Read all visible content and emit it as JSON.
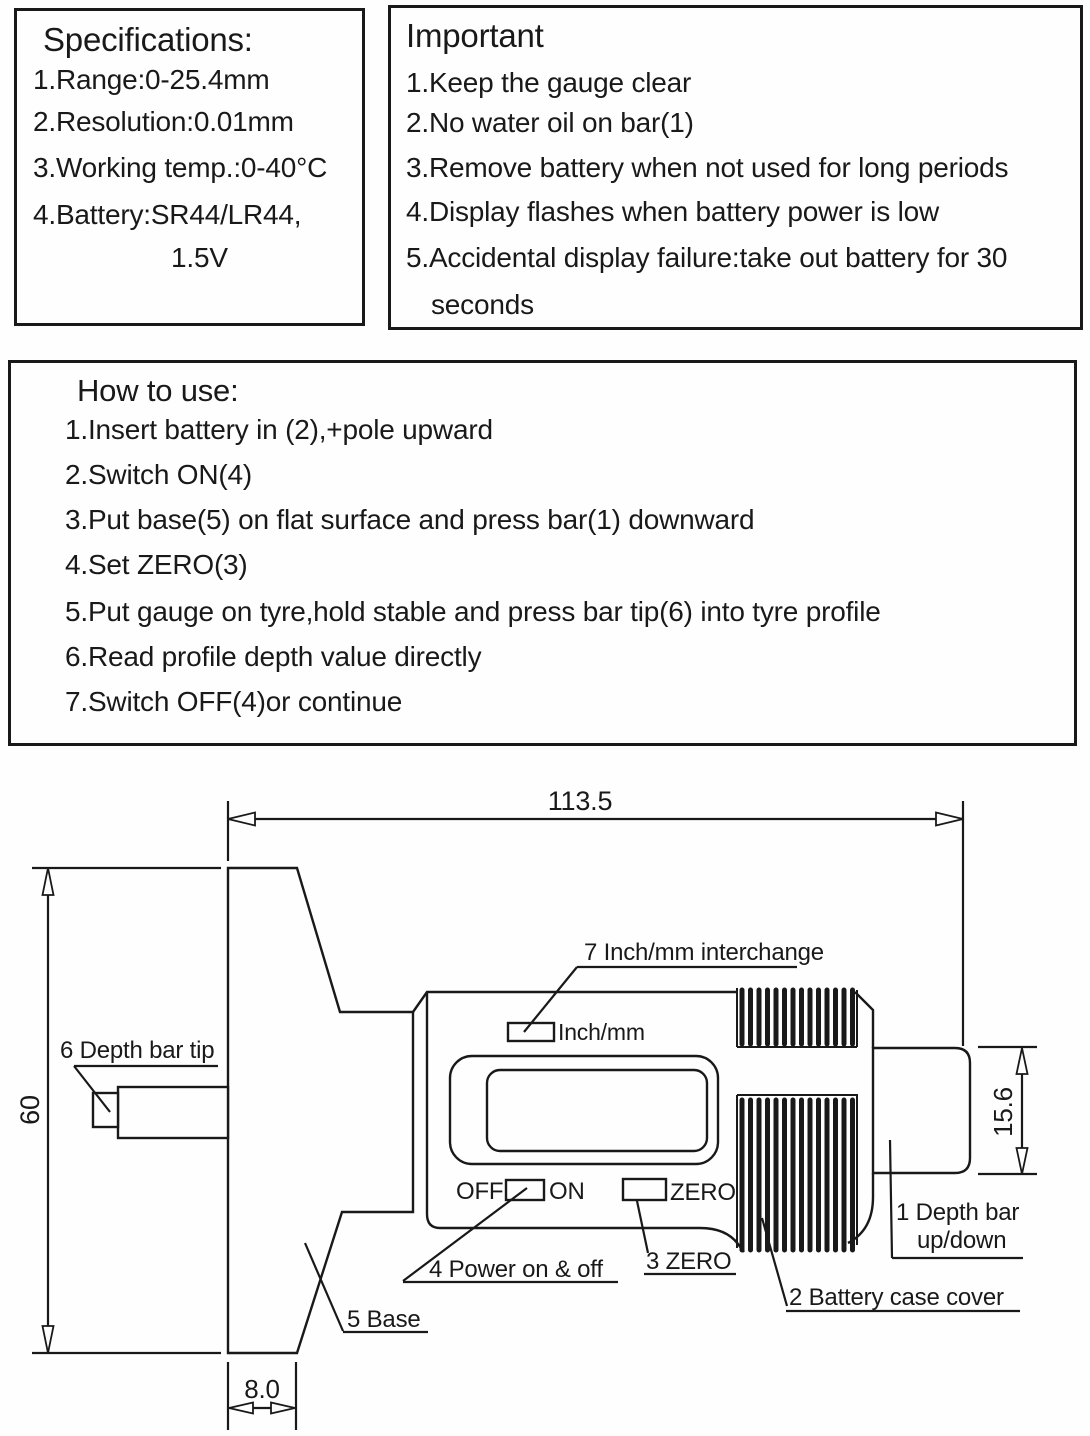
{
  "specifications": {
    "title": "Specifications:",
    "items": [
      "1.Range:0-25.4mm",
      "2.Resolution:0.01mm",
      "3.Working temp.:0-40°C",
      "4.Battery:SR44/LR44,",
      "1.5V"
    ]
  },
  "important": {
    "title": "Important",
    "items": [
      "1.Keep the gauge clear",
      "2.No water oil on bar(1)",
      "3.Remove battery when not used for long periods",
      "4.Display flashes when battery power is low",
      "5.Accidental display failure:take out battery for 30",
      "seconds"
    ]
  },
  "how_to_use": {
    "title": "How to use:",
    "items": [
      "1.Insert battery in (2),+pole upward",
      "2.Switch ON(4)",
      "3.Put base(5) on flat surface and press bar(1) downward",
      "4.Set ZERO(3)",
      "5.Put gauge on tyre,hold stable and press bar tip(6) into tyre profile",
      "6.Read profile depth value directly",
      "7.Switch OFF(4)or continue"
    ]
  },
  "diagram": {
    "dimensions": {
      "overall_length": "113.5",
      "height": "60",
      "base_width": "8.0",
      "bar_height": "15.6"
    },
    "device_labels": {
      "unit_button": "Inch/mm",
      "off": "OFF",
      "on": "ON",
      "zero": "ZERO"
    },
    "callouts": {
      "depth_bar_line1": "1 Depth bar",
      "depth_bar_line2": "up/down",
      "battery_case": "2 Battery case cover",
      "zero": "3 ZERO",
      "power": "4 Power on & off",
      "base": "5 Base",
      "depth_bar_tip": "6 Depth bar tip",
      "inch_mm": "7 Inch/mm interchange"
    },
    "colors": {
      "ink": "#191919",
      "paper": "#fefefe"
    }
  }
}
